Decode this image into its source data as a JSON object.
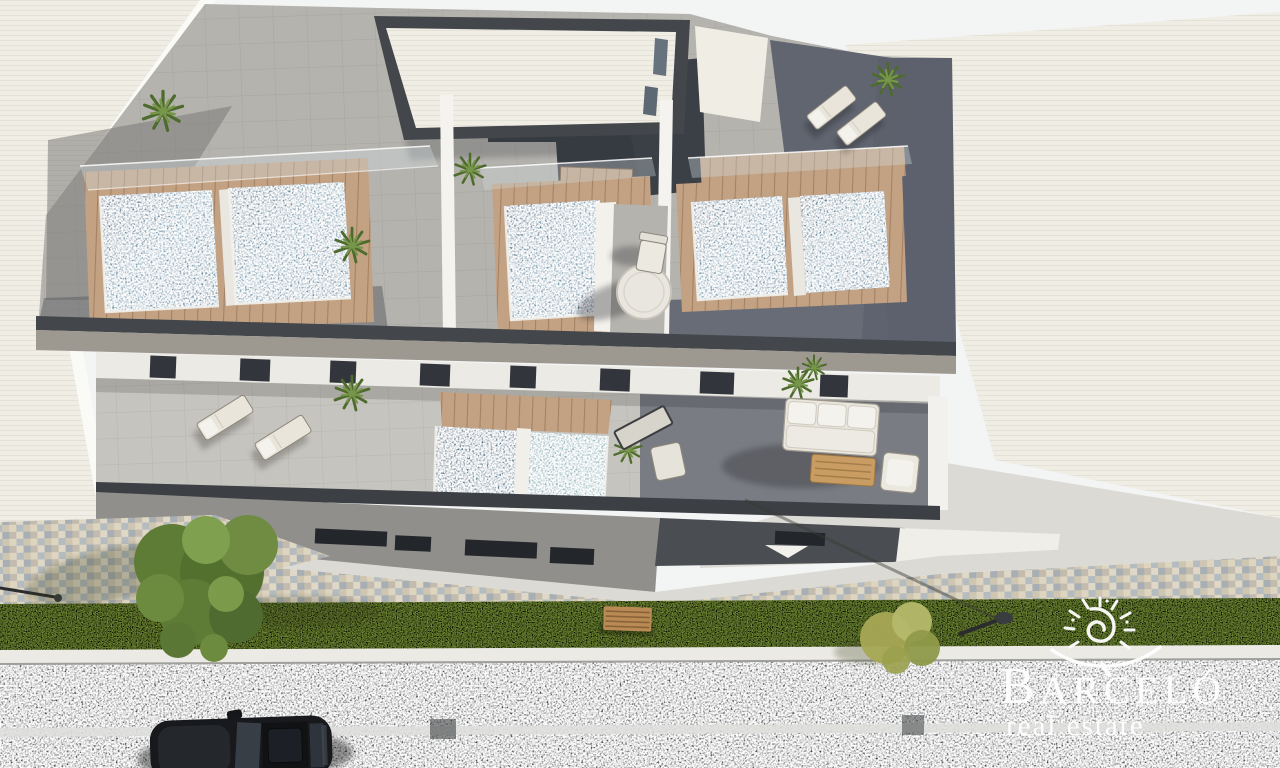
{
  "watermark": {
    "brand": "BARCELÓ",
    "brand_initial": "B",
    "brand_rest": "ARCELÓ",
    "tagline": "real estate",
    "color": "#ffffff",
    "icon": "sun-spiral-icon"
  },
  "scene": {
    "type": "architectural-render",
    "view": "aerial-top-down",
    "description": "3D render of a modern residential building seen from above: rooftop solarium terraces with five plunge pools and glass balustrades, a lower terrace with two plunge pools, sun loungers and an outdoor lounge set, street frontage with paved sidewalk, lawn strip with tree, bench and street lamps, asphalt road with a parked black car, flanked by large white neighboring rooftops.",
    "elements": [
      "neighbor-roof-left",
      "neighbor-roof-right",
      "penthouse-roof",
      "rooftop-terrace-pools",
      "glass-balustrades",
      "roof-plants",
      "lower-terrace-pools",
      "sun-loungers",
      "lounge-sofa-set",
      "street-facade-windows",
      "mosaic-sidewalk",
      "lawn-strip",
      "tree",
      "bench",
      "street-lamp",
      "asphalt-road",
      "road-centerline",
      "parked-car",
      "barcelo-watermark"
    ],
    "palette": {
      "roof_white": "#f0ede4",
      "terrace_tile": "#b5b3ae",
      "terrace_dark": "#5c616d",
      "parapet": "#43464a",
      "fascia": "#9d9890",
      "pool_water": "#54809a",
      "wood_deck": "#c3a284",
      "glass": "#cfdade",
      "lower_floor": "#c6c4be",
      "grass": "#7d993e",
      "pavement_mosaic": "#d3c9b7",
      "apron": "#dcdad4",
      "curb": "#eceae5",
      "road": "#3f4244",
      "road_marking": "#dedfdc",
      "car": "#17191d",
      "tree": "#5f7c37",
      "shrub": "#a8a855"
    }
  }
}
